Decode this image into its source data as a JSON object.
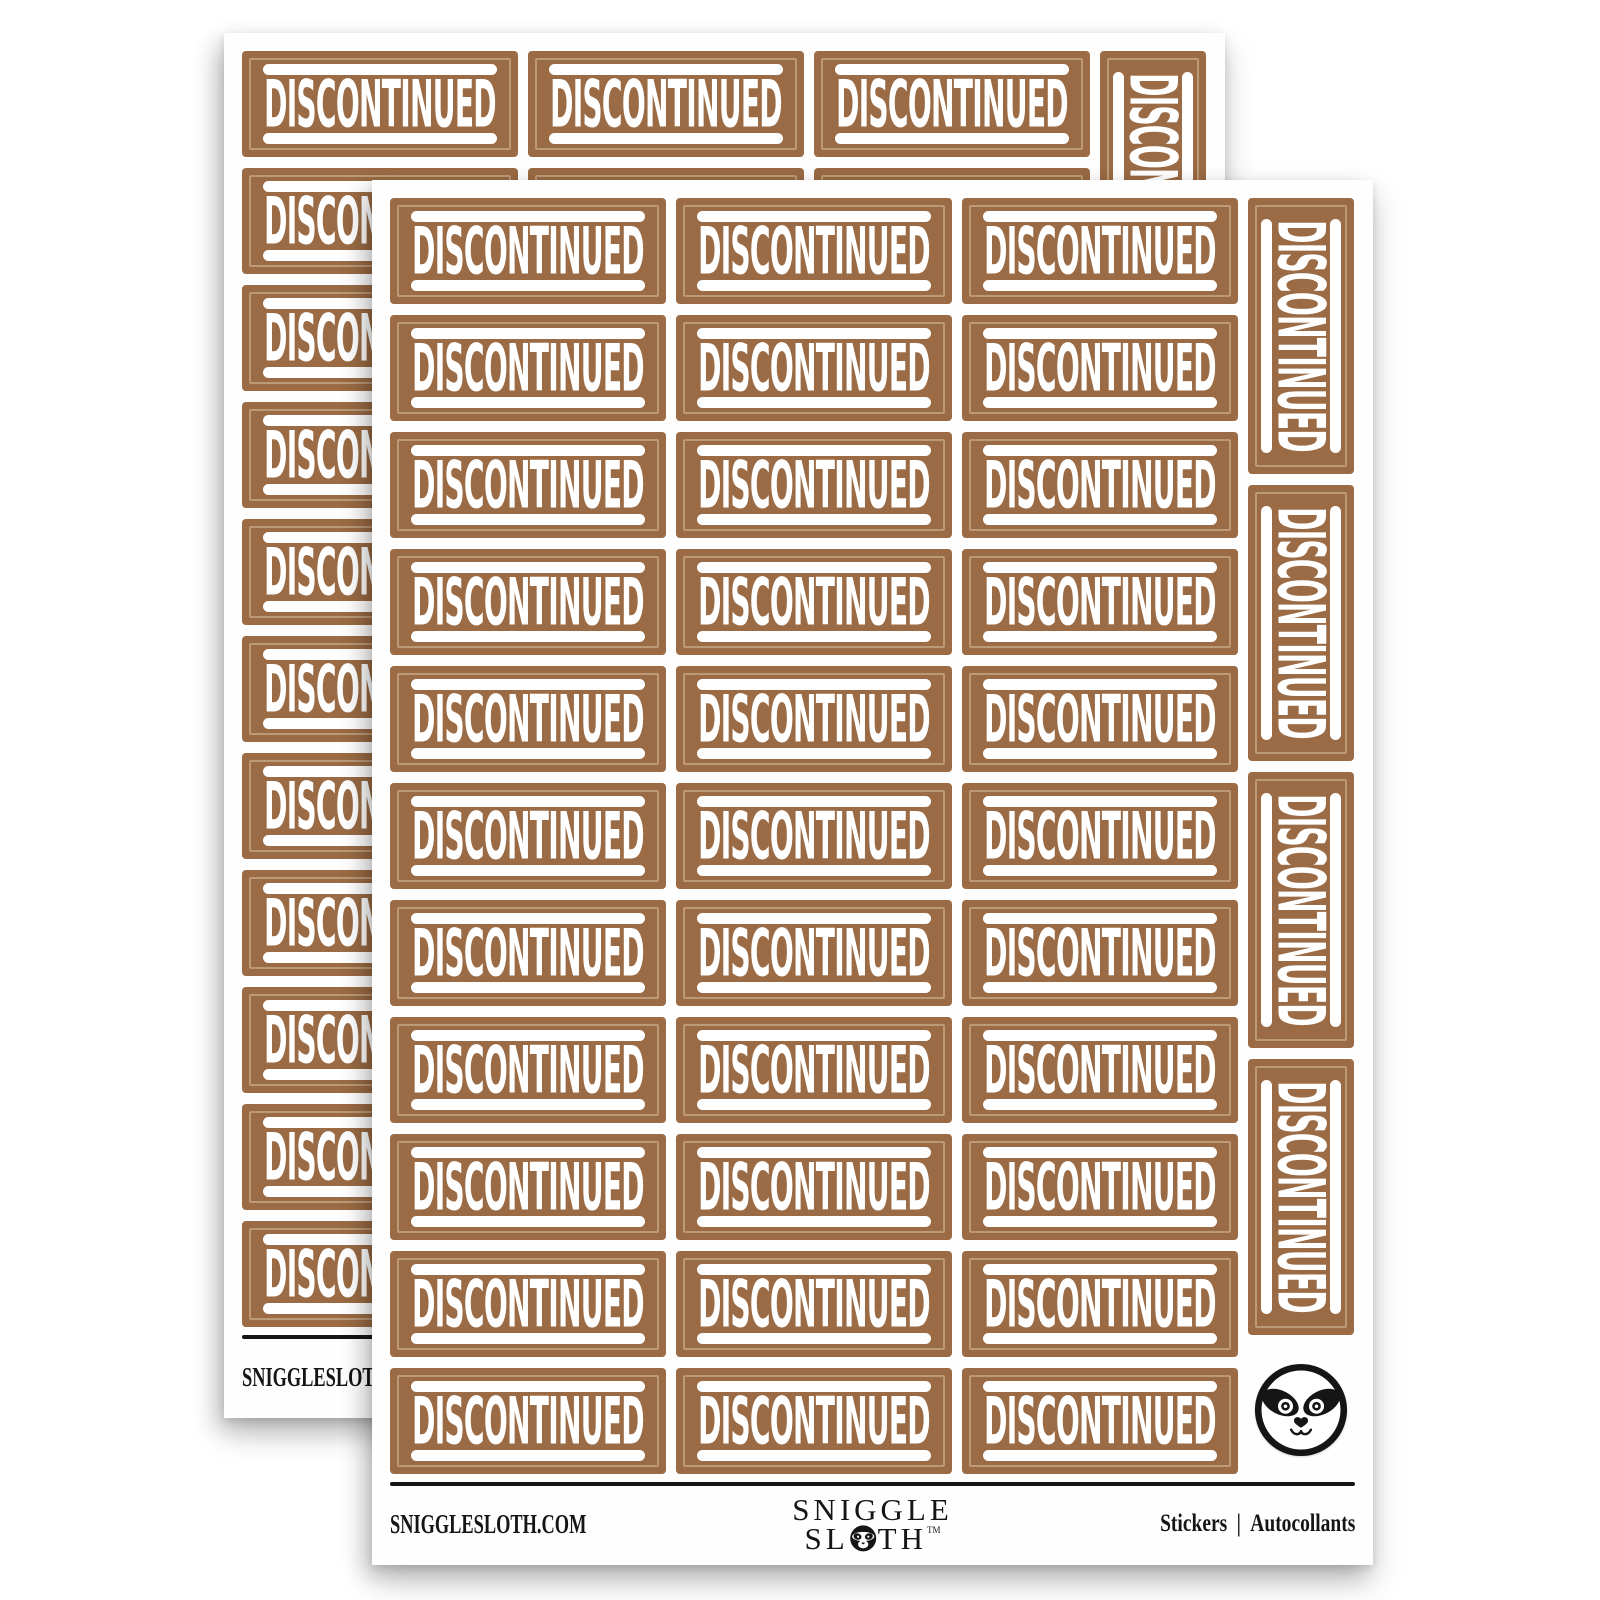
{
  "product": {
    "description": "Sheets of brown DISCONTINUED rectangular stickers",
    "sheet_count": 2
  },
  "sticker": {
    "label": "DISCONTINUED"
  },
  "sheet": {
    "grid": {
      "rows": 11,
      "columns": 3
    },
    "vertical_stickers": 4
  },
  "footer": {
    "website": "SNIGGLESLOTH.COM",
    "brand_line1": "SNIGGLE",
    "brand_line2_start": "SL",
    "brand_line2_end": "TH",
    "trademark": "TM",
    "right_label_en": "Stickers",
    "separator": "|",
    "right_label_fr": "Autocollants"
  },
  "icons": {
    "badge": "sloth-face-badge",
    "logo_o": "sloth-face-logo-o"
  },
  "colors": {
    "sticker_brown": "#9a6b44",
    "sticker_inner_line": "#bc9a78",
    "sticker_text": "#ffffff",
    "ink": "#151515",
    "paper": "#ffffff"
  }
}
